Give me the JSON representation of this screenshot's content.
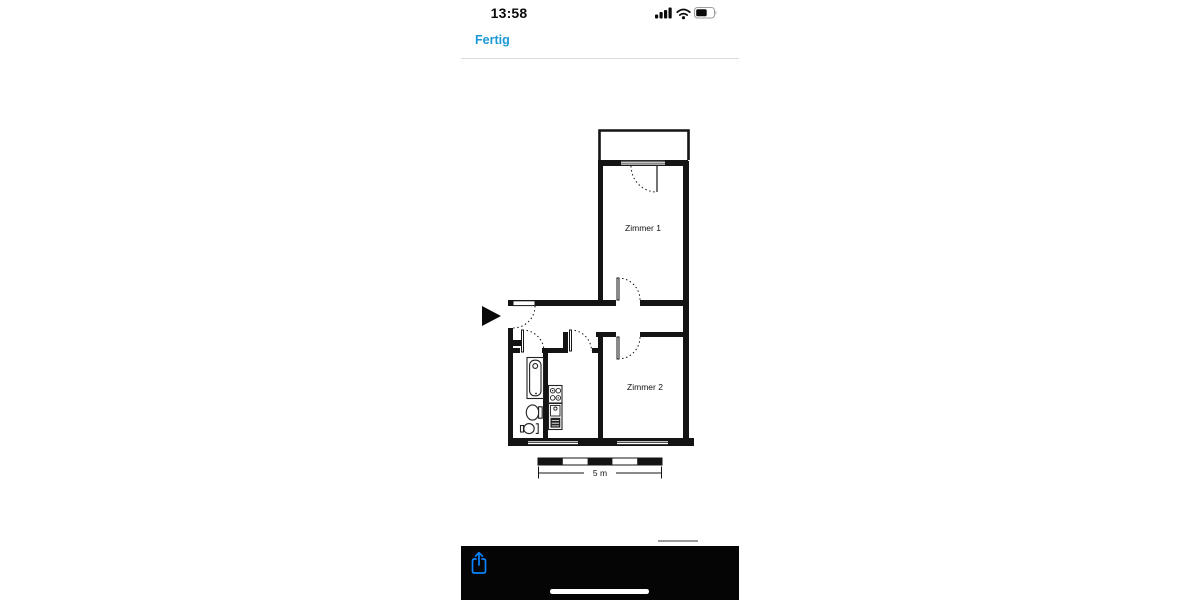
{
  "status_bar": {
    "time": "13:58",
    "signal_icon": "cellular-signal-4-bars",
    "wifi_icon": "wifi",
    "battery_icon": "battery-about-55-percent"
  },
  "nav": {
    "done_label": "Fertig"
  },
  "floor_plan": {
    "room1_label": "Zimmer 1",
    "room2_label": "Zimmer 2",
    "scale_label": "5 m",
    "entrance_icon": "entrance-arrow"
  },
  "toolbar": {
    "share_icon": "share-arrow-up-from-box"
  },
  "colors": {
    "link_blue": "#1a99d6",
    "share_blue": "#0a84ff",
    "wall_black": "#141414"
  }
}
